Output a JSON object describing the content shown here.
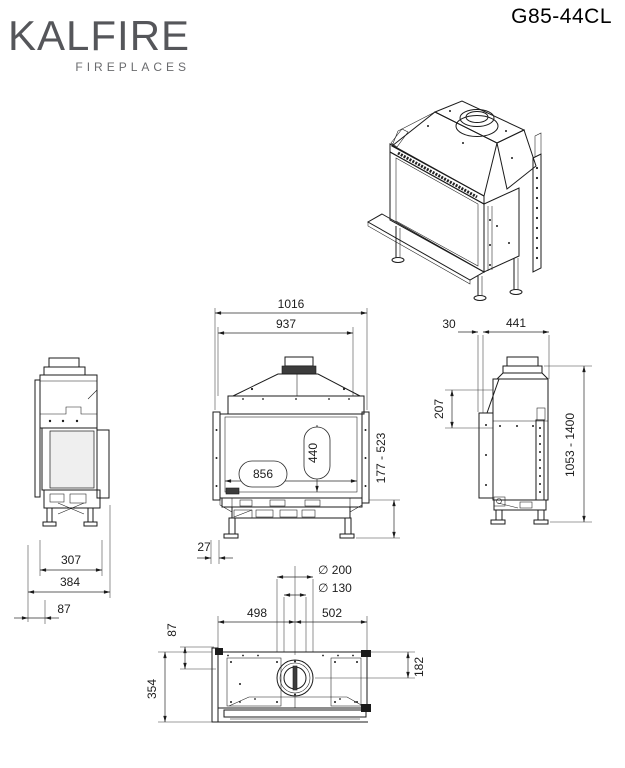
{
  "header": {
    "brand": "KALFIRE",
    "brand_sub": "FIREPLACES",
    "model": "G85-44CL"
  },
  "colors": {
    "line": "#1b1b1b",
    "logo_gray": "#55565a",
    "background": "#ffffff"
  },
  "dimensions": {
    "front": {
      "overall_width": "1016",
      "body_width": "937",
      "glass_width": "856",
      "glass_height": "440",
      "floor_clearance": "177 - 523",
      "frame_offset": "27"
    },
    "left_side": {
      "feet_spacing": "307",
      "overall_depth": "384",
      "front_overhang": "87"
    },
    "right_side": {
      "frame_gap": "30",
      "body_depth": "441",
      "hood_drop": "207",
      "overall_height": "1053 - 1400"
    },
    "top": {
      "flue_outer_dia": "∅ 200",
      "flue_inner_dia": "∅ 130",
      "flue_left": "498",
      "flue_right": "502",
      "back_offset": "87",
      "total_depth": "354",
      "flue_center_offset": "182"
    }
  }
}
